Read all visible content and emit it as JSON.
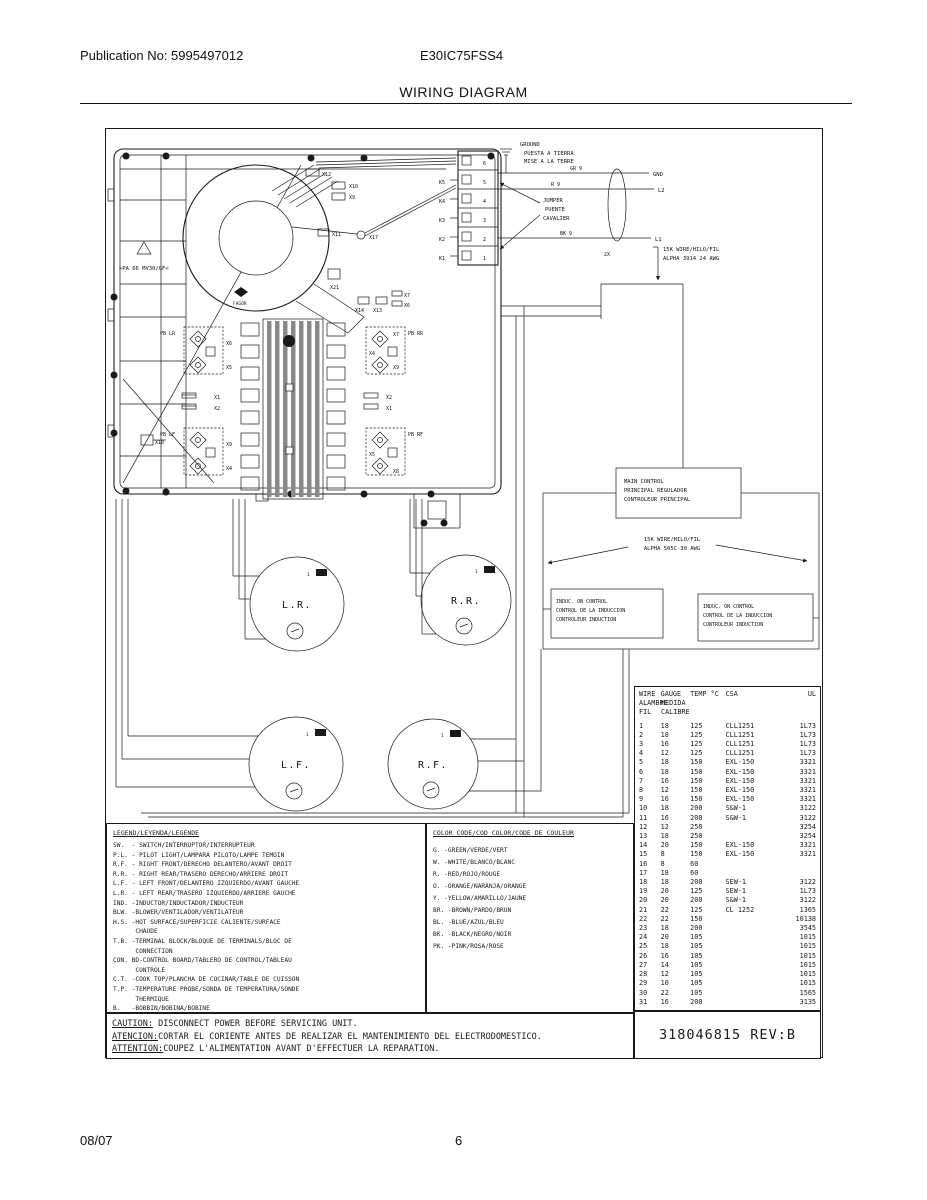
{
  "page": {
    "publication": "Publication No: 5995497012",
    "model": "E30IC75FSS4",
    "title": "WIRING DIAGRAM",
    "footer_date": "08/07",
    "footer_page": "6"
  },
  "diagram": {
    "ground": {
      "l1": "GROUND",
      "l2": "PUESTA A TIERRA",
      "l3": "MISE A LA TERRE"
    },
    "jumper": {
      "l1": "JUMPER",
      "l2": "PUENTE",
      "l3": "CAVALIER"
    },
    "power": {
      "gr": "GR 9",
      "r": "R 9",
      "bk": "BK 9",
      "gnd": "GND",
      "l2": "L2",
      "l1": "L1",
      "x2": "2X"
    },
    "wire_note_top": {
      "l1": "15K WIRE/HILO/FIL",
      "l2": "ALPHA 3914 24 AWG"
    },
    "wire_note_mid": {
      "l1": "15K WIRE/HILO/FIL",
      "l2": "ALPHA 505C-30 AWG"
    },
    "main_control": {
      "l1": "MAIN CONTROL",
      "l2": "PRINCIPAL REGULADOR",
      "l3": "CONTROLEUR PRINCIPAL"
    },
    "induc_left": {
      "l1": "INDUC. ON CONTROL",
      "l2": "CONTROL DE LA INDUCCION",
      "l3": "CONTROLEUR INDUCTION"
    },
    "induc_right": {
      "l1": "INDUC. ON CONTROL",
      "l2": "CONTROL DE LA INDUCCION",
      "l3": "CONTROLEUR INDUCTION"
    },
    "burners": {
      "lr": "L.R.",
      "rr": "R.R.",
      "lf": "L.F.",
      "rf": "R.F."
    },
    "one": "1",
    "cooktop": {
      "material": ">PA 66 MV30/GF<",
      "brand": "FAGOR",
      "pb_lr": "PB LR",
      "pb_lf": "PB LF",
      "pb_rr": "PB RR",
      "pb_rf": "PB RF"
    },
    "connectors": {
      "x1": "X1",
      "x2": "X2",
      "x4": "X4",
      "x5": "X5",
      "x6": "X6",
      "x7": "X7",
      "x8": "X8",
      "x9": "X9",
      "x10": "X10",
      "x11": "X11",
      "x12": "X12",
      "x13": "X13",
      "x14": "X14",
      "x17": "X17",
      "x21": "X21"
    },
    "terminals": [
      "6",
      "5",
      "4",
      "3",
      "2",
      "1"
    ],
    "k_labels": [
      "K5",
      "K4",
      "K3",
      "K2",
      "K1"
    ]
  },
  "legend": {
    "title": "LEGEND/LEYENDA/LEGENDE",
    "lines": [
      "SW.  - SWITCH/INTERRUPTOR/INTERRUPTEUR",
      "P.L. - PILOT LIGHT/LAMPARA PILOTO/LAMPE TEMOIN",
      "R.F. - RIGHT FRONT/DERECHO DELANTERO/AVANT DROIT",
      "R.R. - RIGHT REAR/TRASERO DERECHO/ARRIERE DROIT",
      "L.F. - LEFT FRONT/DELANTERO IZQUIERDO/AVANT GAUCHE",
      "L.R. - LEFT REAR/TRASERO IZQUIERDO/ARRIERE GAUCHE",
      "IND. -INDUCTOR/INDUCTADOR/INDUCTEUR",
      "BLW. -BLOWER/VENTILADOR/VENTILATEUR",
      "H.S. -HOT SURFACE/SUPERFICIE CALIENTE/SURFACE",
      "      CHAUDE",
      "T.B. -TERMINAL BLOCK/BLOQUE DE TERMINALS/BLOC DE",
      "      CONNECTION",
      "CON. BD-CONTROL BOARD/TABLERO DE CONTROL/TABLEAU",
      "      CONTROLE",
      "C.T. -COOK TOP/PLANCHA DE COCINAR/TABLE DE CUISSON",
      "T.P. -TEMPERATURE PROBE/SONDA DE TEMPERATURA/SONDE",
      "      THERMIQUE",
      "B.   -BOBBIN/BOBINA/BOBINE"
    ]
  },
  "color_code": {
    "title": "COLOR CODE/COD COLOR/CODE DE COULEUR",
    "lines": [
      "G. -GREEN/VERDE/VERT",
      "W. -WHITE/BLANCO/BLANC",
      "R. -RED/ROJO/ROUGE",
      "O. -ORANGE/NARANJA/ORANGE",
      "Y. -YELLOW/AMARILLO/JAUNE",
      "BR. -BROWN/PARDO/BRUN",
      "BL. -BLUE/AZUL/BLEU",
      "BK. -BLACK/NEGRO/NOIR",
      "PK. -PINK/ROSA/ROSE"
    ]
  },
  "wire_table": {
    "h1": [
      "WIRE",
      "GAUGE",
      "TEMP °C",
      "CSA",
      "UL"
    ],
    "h2": [
      "ALAMBRE",
      "MEDIDA"
    ],
    "h3": [
      "FIL",
      "CALIBRE"
    ],
    "rows": [
      {
        "w": "1",
        "g": "18",
        "t": "125",
        "c": "CLL1251",
        "u": "1L73"
      },
      {
        "w": "2",
        "g": "18",
        "t": "125",
        "c": "CLL1251",
        "u": "1L73"
      },
      {
        "w": "3",
        "g": "16",
        "t": "125",
        "c": "CLL1251",
        "u": "1L73"
      },
      {
        "w": "4",
        "g": "12",
        "t": "125",
        "c": "CLL1251",
        "u": "1L73"
      },
      {
        "w": "5",
        "g": "18",
        "t": "150",
        "c": "EXL-150",
        "u": "3321"
      },
      {
        "w": "6",
        "g": "18",
        "t": "150",
        "c": "EXL-150",
        "u": "3321"
      },
      {
        "w": "7",
        "g": "16",
        "t": "150",
        "c": "EXL-150",
        "u": "3321"
      },
      {
        "w": "8",
        "g": "12",
        "t": "150",
        "c": "EXL-150",
        "u": "3321"
      },
      {
        "w": "9",
        "g": "16",
        "t": "150",
        "c": "EXL-150",
        "u": "3321"
      },
      {
        "w": "10",
        "g": "18",
        "t": "200",
        "c": "S&W-1",
        "u": "3122"
      },
      {
        "w": "11",
        "g": "16",
        "t": "200",
        "c": "S&W-1",
        "u": "3122"
      },
      {
        "w": "12",
        "g": "12",
        "t": "250",
        "c": "",
        "u": "3254"
      },
      {
        "w": "13",
        "g": "18",
        "t": "250",
        "c": "",
        "u": "3254"
      },
      {
        "w": "14",
        "g": "20",
        "t": "150",
        "c": "EXL-150",
        "u": "3321"
      },
      {
        "w": "15",
        "g": "8",
        "t": "150",
        "c": "EXL-150",
        "u": "3321"
      },
      {
        "w": "16",
        "g": "8",
        "t": "60",
        "c": "",
        "u": ""
      },
      {
        "w": "17",
        "g": "18",
        "t": "60",
        "c": "",
        "u": ""
      },
      {
        "w": "18",
        "g": "18",
        "t": "200",
        "c": "SEW-1",
        "u": "3122"
      },
      {
        "w": "19",
        "g": "20",
        "t": "125",
        "c": "SEW-1",
        "u": "1L73"
      },
      {
        "w": "20",
        "g": "20",
        "t": "200",
        "c": "S&W-1",
        "u": "3122"
      },
      {
        "w": "21",
        "g": "22",
        "t": "125",
        "c": "CL 1252",
        "u": "1365"
      },
      {
        "w": "22",
        "g": "22",
        "t": "150",
        "c": "",
        "u": "10138"
      },
      {
        "w": "23",
        "g": "18",
        "t": "200",
        "c": "",
        "u": "3545"
      },
      {
        "w": "24",
        "g": "20",
        "t": "105",
        "c": "",
        "u": "1015"
      },
      {
        "w": "25",
        "g": "18",
        "t": "105",
        "c": "",
        "u": "1015"
      },
      {
        "w": "26",
        "g": "16",
        "t": "105",
        "c": "",
        "u": "1015"
      },
      {
        "w": "27",
        "g": "14",
        "t": "105",
        "c": "",
        "u": "1015"
      },
      {
        "w": "28",
        "g": "12",
        "t": "105",
        "c": "",
        "u": "1015"
      },
      {
        "w": "29",
        "g": "10",
        "t": "105",
        "c": "",
        "u": "1015"
      },
      {
        "w": "30",
        "g": "22",
        "t": "105",
        "c": "",
        "u": "1565"
      },
      {
        "w": "31",
        "g": "16",
        "t": "200",
        "c": "",
        "u": "3135"
      }
    ]
  },
  "caution": {
    "lines": [
      {
        "label": "CAUTION:",
        "text": " DISCONNECT POWER BEFORE SERVICING UNIT."
      },
      {
        "label": "ATENCION:",
        "text": "CORTAR EL CORIENTE ANTES DE REALIZAR EL MANTENIMIENTO DEL ELECTRODOMESTICO."
      },
      {
        "label": "ATTENTION:",
        "text": "COUPEZ L'ALIMENTATION AVANT D'EFFECTUER LA REPARATION."
      }
    ]
  },
  "part": {
    "number": "318046815 REV:B"
  }
}
